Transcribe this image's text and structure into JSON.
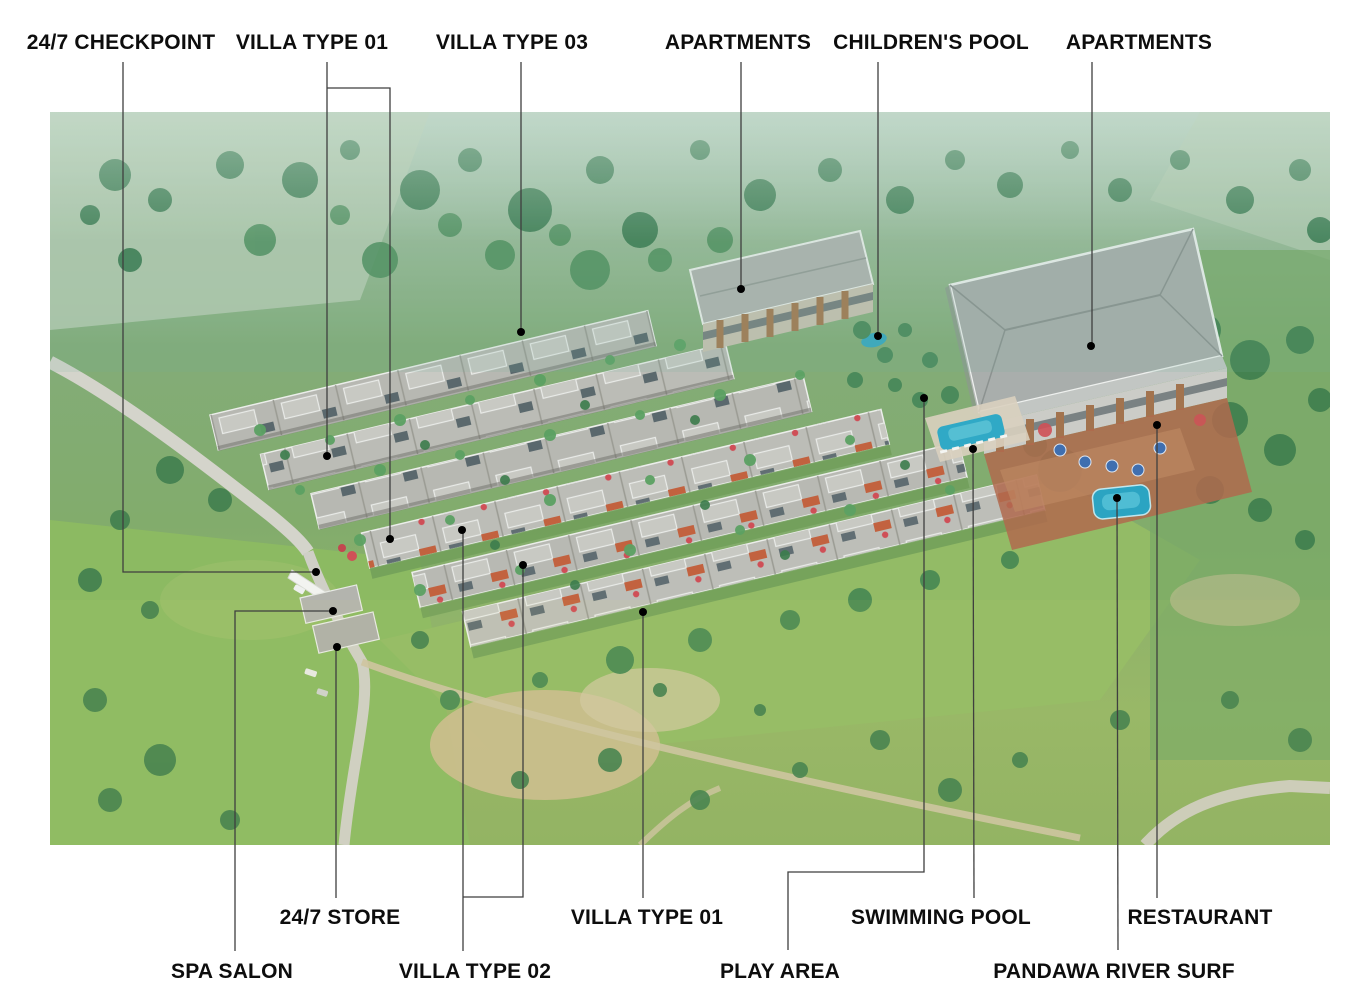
{
  "canvas": {
    "width": 1372,
    "height": 1000,
    "background": "#ffffff"
  },
  "photo": {
    "left": 50,
    "top": 112,
    "width": 1280,
    "height": 733,
    "description": "aerial view of a tropical resort: rows of modern flat-roof villas, two apartment buildings, main building with pools and terrace, surrounded by green fields, palm trees and roads"
  },
  "annotation_style": {
    "line_color": "#3f3f3f",
    "line_width": 1.3,
    "dot_color": "#000000",
    "dot_radius": 4,
    "label_color": "#0d0d0d",
    "font_size": 21
  },
  "callouts": [
    {
      "id": "checkpoint",
      "label": "24/7 CHECKPOINT",
      "label_x": 121,
      "label_y": 43,
      "row": "top",
      "lines": [
        {
          "points": [
            [
              123,
              62
            ],
            [
              123,
              572
            ],
            [
              316,
              572
            ]
          ],
          "dot": [
            316,
            572
          ]
        }
      ]
    },
    {
      "id": "villa-type-01-top",
      "label": "VILLA TYPE 01",
      "label_x": 312,
      "label_y": 43,
      "row": "top",
      "lines": [
        {
          "points": [
            [
              327,
              62
            ],
            [
              327,
              456
            ]
          ],
          "dot": [
            327,
            456
          ]
        },
        {
          "points": [
            [
              327,
              88
            ],
            [
              390,
              88
            ],
            [
              390,
              539
            ]
          ],
          "dot": [
            390,
            539
          ]
        }
      ]
    },
    {
      "id": "villa-type-03",
      "label": "VILLA TYPE 03",
      "label_x": 512,
      "label_y": 43,
      "row": "top",
      "lines": [
        {
          "points": [
            [
              521,
              62
            ],
            [
              521,
              332
            ]
          ],
          "dot": [
            521,
            332
          ]
        }
      ]
    },
    {
      "id": "apartments-left",
      "label": "APARTMENTS",
      "label_x": 738,
      "label_y": 43,
      "row": "top",
      "lines": [
        {
          "points": [
            [
              741,
              62
            ],
            [
              741,
              289
            ]
          ],
          "dot": [
            741,
            289
          ]
        }
      ]
    },
    {
      "id": "childrens-pool",
      "label": "CHILDREN'S POOL",
      "label_x": 931,
      "label_y": 43,
      "row": "top",
      "lines": [
        {
          "points": [
            [
              878,
              62
            ],
            [
              878,
              336
            ]
          ],
          "dot": [
            878,
            336
          ]
        }
      ]
    },
    {
      "id": "apartments-right",
      "label": "APARTMENTS",
      "label_x": 1139,
      "label_y": 43,
      "row": "top",
      "lines": [
        {
          "points": [
            [
              1092,
              62
            ],
            [
              1092,
              346
            ]
          ],
          "dot": [
            1091,
            346
          ]
        }
      ]
    },
    {
      "id": "store",
      "label": "24/7 STORE",
      "label_x": 340,
      "label_y": 918,
      "row": "bottom-upper",
      "lines": [
        {
          "points": [
            [
              336,
              898
            ],
            [
              336,
              647
            ]
          ],
          "dot": [
            337,
            647
          ]
        }
      ]
    },
    {
      "id": "spa-salon",
      "label": "SPA SALON",
      "label_x": 232,
      "label_y": 972,
      "row": "bottom-lower",
      "lines": [
        {
          "points": [
            [
              235,
              951
            ],
            [
              235,
              611
            ],
            [
              333,
              611
            ]
          ],
          "dot": [
            333,
            611
          ]
        }
      ]
    },
    {
      "id": "villa-type-02",
      "label": "VILLA TYPE 02",
      "label_x": 475,
      "label_y": 972,
      "row": "bottom-lower",
      "lines": [
        {
          "points": [
            [
              463,
              951
            ],
            [
              463,
              530
            ]
          ],
          "dot": [
            462,
            530
          ]
        },
        {
          "points": [
            [
              463,
              897
            ],
            [
              523,
              897
            ],
            [
              523,
              565
            ]
          ],
          "dot": [
            523,
            565
          ]
        }
      ]
    },
    {
      "id": "villa-type-01-bottom",
      "label": "VILLA TYPE 01",
      "label_x": 647,
      "label_y": 918,
      "row": "bottom-upper",
      "lines": [
        {
          "points": [
            [
              643,
              898
            ],
            [
              643,
              612
            ]
          ],
          "dot": [
            643,
            612
          ]
        }
      ]
    },
    {
      "id": "play-area",
      "label": "PLAY AREA",
      "label_x": 780,
      "label_y": 972,
      "row": "bottom-lower",
      "lines": [
        {
          "points": [
            [
              788,
              950
            ],
            [
              788,
              872
            ],
            [
              924,
              872
            ],
            [
              924,
              398
            ]
          ],
          "dot": [
            924,
            398
          ]
        }
      ]
    },
    {
      "id": "swimming-pool",
      "label": "SWIMMING POOL",
      "label_x": 941,
      "label_y": 918,
      "row": "bottom-upper",
      "lines": [
        {
          "points": [
            [
              974,
              898
            ],
            [
              973,
              449
            ]
          ],
          "dot": [
            973,
            449
          ]
        }
      ]
    },
    {
      "id": "pandawa-river-surf",
      "label": "PANDAWA RIVER SURF",
      "label_x": 1114,
      "label_y": 972,
      "row": "bottom-lower",
      "lines": [
        {
          "points": [
            [
              1118,
              950
            ],
            [
              1117,
              498
            ]
          ],
          "dot": [
            1117,
            498
          ]
        }
      ]
    },
    {
      "id": "restaurant",
      "label": "RESTAURANT",
      "label_x": 1200,
      "label_y": 918,
      "row": "bottom-upper",
      "lines": [
        {
          "points": [
            [
              1157,
              898
            ],
            [
              1157,
              425
            ]
          ],
          "dot": [
            1157,
            425
          ]
        }
      ]
    }
  ]
}
